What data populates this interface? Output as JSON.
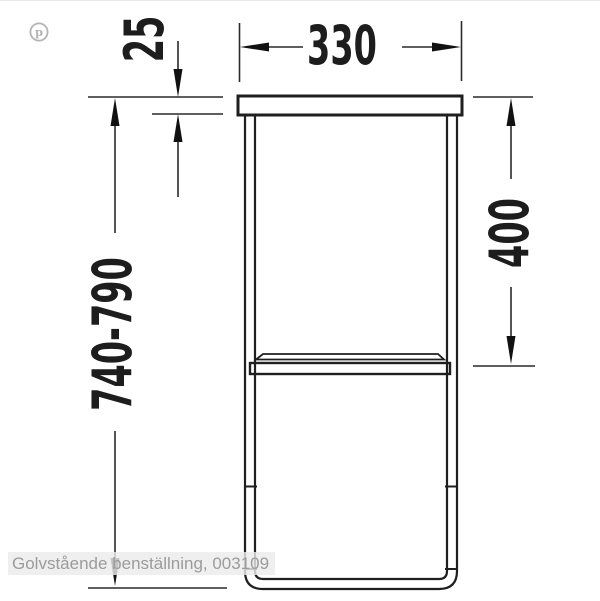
{
  "drawing": {
    "title": "floor-standing leg frame technical drawing",
    "line_color": "#1f1f1f",
    "background": "#ffffff"
  },
  "dimensions": {
    "top_width": {
      "value": "330",
      "unit": "mm",
      "orientation": "horizontal"
    },
    "top_thickness": {
      "value": "25",
      "unit": "mm",
      "orientation": "vertical"
    },
    "shelf_height": {
      "value": "400",
      "unit": "mm",
      "orientation": "vertical"
    },
    "total_height": {
      "value": "740-790",
      "unit": "mm",
      "orientation": "vertical"
    }
  },
  "caption": {
    "text": "Golvstående benställning, 003109",
    "text_color": "#9b9b9b",
    "band_color": "#ebebeb"
  },
  "watermark": {
    "name": "pinterest",
    "glyph": "p",
    "color": "#b4b4b4"
  }
}
